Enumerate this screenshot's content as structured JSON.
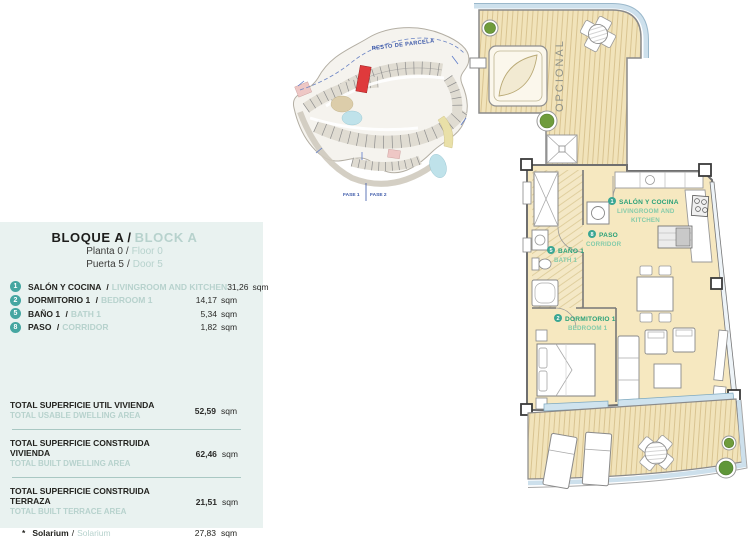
{
  "sep": "/",
  "colors": {
    "panel_bg": "#e9f2f0",
    "accent_teal": "#45a6a1",
    "muted_teal_text": "#b7d2cd",
    "plan_green": "#2aa179",
    "site_blue": "#3a57a8",
    "highlight_red": "#df3a3c",
    "room_beige": "#f6e8c0",
    "deck_beige": "#f1e3ba",
    "railing_blue": "#cde0ec"
  },
  "panel": {
    "title_es": "BLOQUE A",
    "title_en": "BLOCK A",
    "floor_es": "Planta 0",
    "floor_en": "Floor 0",
    "door_es": "Puerta 5",
    "door_en": "Door 5",
    "rooms": [
      {
        "num": "1",
        "name_es": "SALÓN Y COCINA",
        "name_en": "LIVINGROOM AND KITCHEN",
        "area": "31,26",
        "unit": "sqm"
      },
      {
        "num": "2",
        "name_es": "DORMITORIO 1",
        "name_en": "BEDROOM 1",
        "area": "14,17",
        "unit": "sqm"
      },
      {
        "num": "5",
        "name_es": "BAÑO 1",
        "name_en": "BATH 1",
        "area": "5,34",
        "unit": "sqm"
      },
      {
        "num": "8",
        "name_es": "PASO",
        "name_en": "CORRIDOR",
        "area": "1,82",
        "unit": "sqm"
      }
    ],
    "totals": [
      {
        "label_es": "TOTAL SUPERFICIE UTIL VIVIENDA",
        "label_en": "TOTAL USABLE DWELLING AREA",
        "value": "52,59",
        "unit": "sqm"
      },
      {
        "label_es": "TOTAL SUPERFICIE CONSTRUIDA VIVIENDA",
        "label_en": "TOTAL BUILT DWELLING AREA",
        "value": "62,46",
        "unit": "sqm"
      },
      {
        "label_es": "TOTAL SUPERFICIE CONSTRUIDA TERRAZA",
        "label_en": "TOTAL BUILT TERRACE AREA",
        "value": "21,51",
        "unit": "sqm"
      }
    ],
    "solarium": {
      "star": "*",
      "label_es": "Solarium",
      "label_en": "Solarium",
      "value": "27,83",
      "unit": "sqm"
    }
  },
  "site_plan": {
    "resto_label": "RESTO DE PARCELA",
    "fase1_label": "FASE 1",
    "fase2_label": "FASE 2"
  },
  "floor_plan": {
    "opcional_label": "OPCIONAL",
    "salon": {
      "num": "1",
      "name_es": "SALÓN Y COCINA",
      "name_en_line1": "LIVINGROOM AND",
      "name_en_line2": "KITCHEN"
    },
    "paso": {
      "num": "8",
      "name_es": "PASO",
      "name_en": "CORRIDOR"
    },
    "bano": {
      "num": "5",
      "name_es": "BAÑO 1",
      "name_en": "BATH 1"
    },
    "dormitorio": {
      "num": "2",
      "name_es": "DORMITORIO 1",
      "name_en": "BEDROOM 1"
    }
  }
}
